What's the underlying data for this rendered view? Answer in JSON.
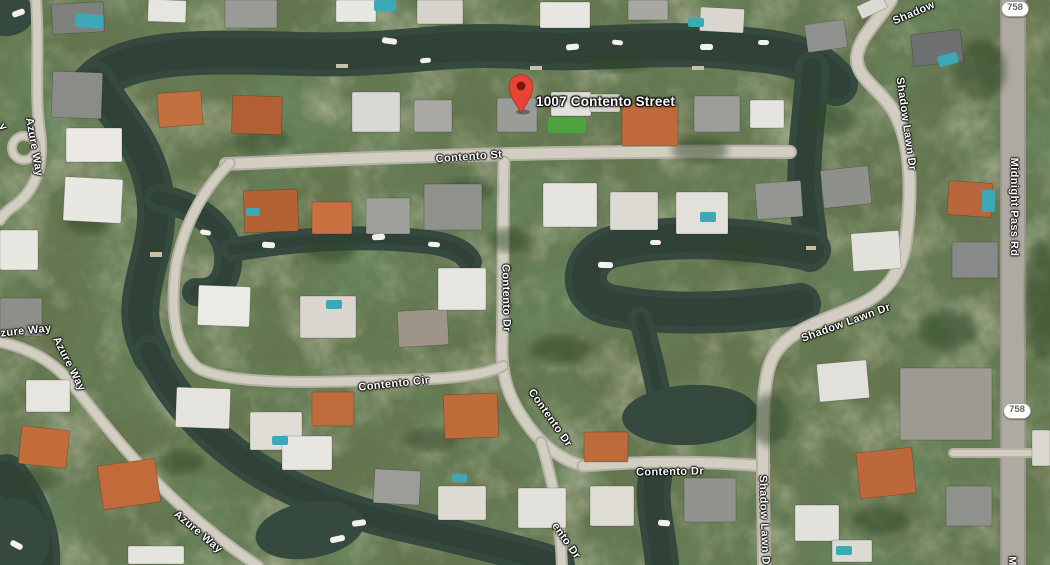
{
  "map": {
    "marker": {
      "label": "1007 Contento Street"
    },
    "street_labels": [
      {
        "name": "contento-st",
        "text": "Contento St",
        "x": 469,
        "y": 157,
        "rot": -4
      },
      {
        "name": "contento-dr-upper",
        "text": "Contento Dr",
        "x": 506,
        "y": 298,
        "rot": 89
      },
      {
        "name": "contento-cir",
        "text": "Contento Cir",
        "x": 394,
        "y": 384,
        "rot": -6
      },
      {
        "name": "contento-dr-mid",
        "text": "Contento Dr",
        "x": 550,
        "y": 418,
        "rot": 55
      },
      {
        "name": "contento-dr-lower",
        "text": "Contento Dr",
        "x": 670,
        "y": 472,
        "rot": -1
      },
      {
        "name": "contento-dr-south-partial",
        "text": "ento Dr",
        "x": 566,
        "y": 541,
        "rot": 55
      },
      {
        "name": "shadow-lawn-dr-top-partial",
        "text": "Shadow",
        "x": 914,
        "y": 13,
        "rot": -23
      },
      {
        "name": "shadow-lawn-dr-east",
        "text": "Shadow Lawn Dr",
        "x": 906,
        "y": 124,
        "rot": 82
      },
      {
        "name": "shadow-lawn-dr-mid",
        "text": "Shadow Lawn Dr",
        "x": 846,
        "y": 323,
        "rot": -20
      },
      {
        "name": "shadow-lawn-dr-south-partial",
        "text": "Shadow Lawn D",
        "x": 764,
        "y": 520,
        "rot": 88
      },
      {
        "name": "midnight-pass-rd",
        "text": "Midnight Pass Rd",
        "x": 1014,
        "y": 207,
        "rot": 90
      },
      {
        "name": "midnight-pass-rd-partial",
        "text": "M",
        "x": 1012,
        "y": 561,
        "rot": 90
      },
      {
        "name": "azure-way-north",
        "text": "Azure Way",
        "x": 34,
        "y": 147,
        "rot": 80
      },
      {
        "name": "azure-way-west-partial",
        "text": "zure Way",
        "x": 26,
        "y": 331,
        "rot": -6
      },
      {
        "name": "azure-way-mid",
        "text": "Azure Way",
        "x": 69,
        "y": 364,
        "rot": 63
      },
      {
        "name": "azure-way-south",
        "text": "Azure Way",
        "x": 198,
        "y": 532,
        "rot": 40
      },
      {
        "name": "street-partial-y",
        "text": "y",
        "x": 3,
        "y": 127,
        "rot": 55
      }
    ],
    "route_badges": [
      {
        "text": "758",
        "x": 1015,
        "y": 9
      },
      {
        "text": "758",
        "x": 1017,
        "y": 411
      }
    ]
  },
  "colors": {
    "vegetation_base": "#66754e",
    "water": "#35493e",
    "water_deep": "#2a3a31",
    "road_outer": "#b5b1a5",
    "road_inner": "#d2cec2",
    "marker_red": "#e94335",
    "marker_hole": "#791610",
    "label_text": "#ffffff",
    "badge_bg": "#fdfdfc",
    "badge_text": "#636669",
    "pool": "#3da8b6",
    "boat": "#f2f1ed",
    "dock": "#cbbfa4",
    "lawn": "#4aa53c",
    "tree": "#2f4427"
  },
  "scenery": {
    "water": [
      {
        "d": "M 92,86 C 120,52 190,50 300,54 C 400,57 440,42 520,47 C 600,52 650,40 735,48 C 780,52 815,55 836,84",
        "w": 44
      },
      {
        "d": "M 812,68 C 812,105 800,160 806,205 C 809,228 812,240 810,255",
        "w": 34
      },
      {
        "d": "M 810,250 C 745,237 665,233 612,247 C 580,256 575,296 610,305 C 672,318 745,312 800,304",
        "w": 42
      },
      {
        "d": "M 640,318 C 648,345 653,365 658,390",
        "w": 24
      },
      {
        "d": "M 95,80 C 118,118 142,140 152,180 C 163,222 150,252 143,287 C 137,317 141,333 152,356",
        "w": 38
      },
      {
        "d": "M 158,198 C 200,206 232,230 228,264 C 226,286 212,294 196,292",
        "w": 28
      },
      {
        "d": "M 232,250 C 290,240 360,234 428,242 C 452,245 466,252 470,262",
        "w": 24
      },
      {
        "d": "M 150,352 C 174,400 210,438 252,466 C 296,494 348,512 400,524 C 440,533 470,540 500,548 C 528,555 546,560 558,565",
        "w": 34
      },
      {
        "ellipse": [
          310,
          530,
          55,
          28,
          -10
        ]
      },
      {
        "ellipse": [
          690,
          415,
          68,
          30,
          -3
        ]
      },
      {
        "d": "M 655,478 C 650,505 660,535 662,565",
        "w": 34
      },
      {
        "d": "M 6,476 C 28,504 40,534 38,566",
        "w": 44
      },
      {
        "ellipse": [
          12,
          538,
          38,
          40,
          0
        ]
      },
      {
        "ellipse": [
          6,
          14,
          28,
          22,
          0
        ]
      }
    ],
    "roads": [
      {
        "d": "M 226,164 C 400,156 600,150 790,152",
        "w": 14
      },
      {
        "d": "M 504,162 C 502,230 504,300 502,345 C 501,382 512,404 530,428 C 548,451 566,462 585,466",
        "w": 13
      },
      {
        "d": "M 541,442 C 552,478 560,515 562,566",
        "w": 12
      },
      {
        "d": "M 583,466 C 645,461 706,461 764,466",
        "w": 13
      },
      {
        "d": "M 230,163 C 206,186 184,222 176,266 C 170,310 174,348 198,368 C 230,386 320,382 400,380 C 448,379 482,376 503,366",
        "w": 12
      },
      {
        "d": "M 891,0 C 876,24 860,36 857,56 C 855,78 880,88 894,112 C 910,140 913,185 906,240 C 899,291 868,302 838,314 C 800,329 777,340 769,367 C 762,392 763,430 763,470 C 763,505 764,535 764,566",
        "w": 14
      },
      {
        "d": "M 1013,0 L 1013,566",
        "w": 26,
        "c1": "#9b978f",
        "c2": "#aeaaa1"
      },
      {
        "d": "M 36,0 C 40,52 34,92 40,132 C 45,166 34,192 14,206 C 7,211 2,216 0,220",
        "w": 12
      },
      {
        "d": "M 0,342 C 28,348 52,360 72,384 C 98,416 122,448 156,482 C 190,516 222,542 258,566",
        "w": 12
      },
      {
        "d": "M 953,453 L 1050,453",
        "w": 10
      },
      {
        "circle": [
          24,
          148,
          12
        ],
        "w": 10
      }
    ],
    "buildings": [
      [
        52,
        3,
        52,
        30,
        -3,
        "#7e807c"
      ],
      [
        148,
        0,
        38,
        22,
        2,
        "#e7e5e0"
      ],
      [
        225,
        0,
        52,
        28,
        0,
        "#9a9a96"
      ],
      [
        336,
        0,
        40,
        22,
        0,
        "#e9e7e2"
      ],
      [
        417,
        0,
        46,
        24,
        0,
        "#d6d3cc"
      ],
      [
        540,
        2,
        50,
        26,
        0,
        "#e8e6e1"
      ],
      [
        628,
        0,
        40,
        20,
        0,
        "#a8a7a2"
      ],
      [
        700,
        8,
        44,
        24,
        3,
        "#d9d6cf"
      ],
      [
        806,
        22,
        40,
        28,
        -8,
        "#8f918e"
      ],
      [
        858,
        0,
        28,
        14,
        -25,
        "#dcdad4"
      ],
      [
        912,
        32,
        50,
        32,
        -6,
        "#6e7071"
      ],
      [
        52,
        72,
        50,
        46,
        2,
        "#8a8c88"
      ],
      [
        66,
        128,
        56,
        34,
        0,
        "#ece9e4"
      ],
      [
        158,
        92,
        44,
        34,
        -4,
        "#c2703f"
      ],
      [
        232,
        96,
        50,
        38,
        2,
        "#b35f33"
      ],
      [
        352,
        92,
        48,
        40,
        0,
        "#d9d8d4"
      ],
      [
        414,
        100,
        38,
        32,
        0,
        "#a9a8a3"
      ],
      [
        497,
        98,
        40,
        34,
        0,
        "#9b9c98"
      ],
      [
        551,
        92,
        40,
        24,
        0,
        "#e4e2dc"
      ],
      [
        590,
        94,
        30,
        18,
        0,
        "#d8d5ce"
      ],
      [
        622,
        104,
        56,
        42,
        0,
        "#c06a3b"
      ],
      [
        694,
        96,
        46,
        36,
        0,
        "#9d9e9a"
      ],
      [
        750,
        100,
        34,
        28,
        0,
        "#e6e4df"
      ],
      [
        64,
        178,
        58,
        44,
        3,
        "#e9e7e1"
      ],
      [
        244,
        190,
        54,
        42,
        -2,
        "#b46134"
      ],
      [
        312,
        202,
        40,
        32,
        0,
        "#c97040"
      ],
      [
        366,
        198,
        44,
        36,
        0,
        "#9fa09c"
      ],
      [
        424,
        184,
        58,
        46,
        0,
        "#8f918d"
      ],
      [
        543,
        183,
        54,
        44,
        0,
        "#e6e4de"
      ],
      [
        610,
        192,
        48,
        38,
        0,
        "#dcdad3"
      ],
      [
        676,
        192,
        52,
        42,
        0,
        "#e2e0da"
      ],
      [
        756,
        182,
        46,
        36,
        -4,
        "#959692"
      ],
      [
        198,
        286,
        52,
        40,
        2,
        "#eceae5"
      ],
      [
        300,
        296,
        56,
        42,
        0,
        "#d8d6cf"
      ],
      [
        398,
        310,
        50,
        36,
        -3,
        "#9e9488"
      ],
      [
        438,
        268,
        48,
        42,
        0,
        "#e8e6e0"
      ],
      [
        822,
        168,
        48,
        38,
        -6,
        "#8e908c"
      ],
      [
        852,
        232,
        48,
        38,
        -4,
        "#e3e1db"
      ],
      [
        948,
        182,
        44,
        34,
        4,
        "#b9663a"
      ],
      [
        952,
        242,
        46,
        36,
        0,
        "#87898a"
      ],
      [
        0,
        230,
        38,
        40,
        0,
        "#e9e7e1"
      ],
      [
        0,
        298,
        42,
        38,
        0,
        "#8d8f8b"
      ],
      [
        26,
        380,
        44,
        32,
        0,
        "#e7e5df"
      ],
      [
        20,
        428,
        48,
        38,
        6,
        "#c26c3c"
      ],
      [
        100,
        462,
        58,
        44,
        -8,
        "#c16a3a"
      ],
      [
        128,
        546,
        56,
        18,
        0,
        "#e6e4de"
      ],
      [
        176,
        388,
        54,
        40,
        2,
        "#e5e3dd"
      ],
      [
        250,
        412,
        52,
        38,
        0,
        "#dfddd6"
      ],
      [
        312,
        392,
        42,
        34,
        0,
        "#c06b3b"
      ],
      [
        444,
        394,
        54,
        44,
        -2,
        "#bf6b39"
      ],
      [
        584,
        432,
        44,
        30,
        0,
        "#bf6a3a"
      ],
      [
        282,
        436,
        50,
        34,
        0,
        "#e8e6e0"
      ],
      [
        374,
        470,
        46,
        34,
        3,
        "#9c9d99"
      ],
      [
        438,
        486,
        48,
        34,
        0,
        "#dddbd4"
      ],
      [
        518,
        488,
        48,
        40,
        0,
        "#e3e1db"
      ],
      [
        590,
        486,
        44,
        40,
        0,
        "#dedcd5"
      ],
      [
        684,
        478,
        52,
        44,
        0,
        "#90928e"
      ],
      [
        818,
        362,
        50,
        38,
        -5,
        "#e2e0da"
      ],
      [
        900,
        368,
        92,
        72,
        0,
        "#9d9a91"
      ],
      [
        858,
        450,
        56,
        46,
        -6,
        "#bd683a"
      ],
      [
        946,
        486,
        46,
        40,
        0,
        "#8f918d"
      ],
      [
        795,
        505,
        44,
        36,
        0,
        "#e4e2dc"
      ],
      [
        832,
        540,
        40,
        22,
        0,
        "#dcdad3"
      ],
      [
        1032,
        430,
        18,
        36,
        0,
        "#dad7d0"
      ]
    ],
    "pools": [
      [
        938,
        54,
        20,
        11,
        -15
      ],
      [
        982,
        190,
        13,
        22,
        0
      ],
      [
        75,
        14,
        28,
        14,
        5
      ],
      [
        246,
        208,
        14,
        8,
        0
      ],
      [
        326,
        300,
        16,
        9,
        0
      ],
      [
        700,
        212,
        16,
        10,
        0
      ],
      [
        272,
        436,
        16,
        9,
        0
      ],
      [
        452,
        474,
        15,
        8,
        0
      ],
      [
        836,
        546,
        16,
        9,
        0
      ],
      [
        374,
        0,
        22,
        11,
        0
      ],
      [
        688,
        18,
        16,
        9,
        0
      ]
    ],
    "boats": [
      [
        382,
        38,
        15,
        6,
        8
      ],
      [
        420,
        58,
        11,
        5,
        -4
      ],
      [
        566,
        44,
        13,
        6,
        -6
      ],
      [
        612,
        40,
        11,
        5,
        6
      ],
      [
        700,
        44,
        13,
        6,
        0
      ],
      [
        758,
        40,
        11,
        5,
        0
      ],
      [
        598,
        262,
        15,
        6,
        2
      ],
      [
        650,
        240,
        11,
        5,
        0
      ],
      [
        330,
        536,
        15,
        6,
        -12
      ],
      [
        352,
        520,
        14,
        6,
        -8
      ],
      [
        10,
        542,
        13,
        6,
        28
      ],
      [
        12,
        10,
        13,
        6,
        -20
      ],
      [
        262,
        242,
        13,
        6,
        3
      ],
      [
        372,
        234,
        13,
        6,
        -3
      ],
      [
        428,
        242,
        12,
        5,
        4
      ],
      [
        658,
        520,
        12,
        6,
        4
      ],
      [
        200,
        230,
        11,
        5,
        10
      ]
    ],
    "docks": [
      [
        336,
        64,
        12,
        4
      ],
      [
        530,
        66,
        12,
        4
      ],
      [
        692,
        66,
        12,
        4
      ],
      [
        150,
        252,
        12,
        5
      ],
      [
        806,
        246,
        10,
        4
      ]
    ],
    "lawns": [
      [
        548,
        117,
        38,
        16
      ]
    ],
    "trees": [
      [
        260,
        140,
        30,
        14
      ],
      [
        470,
        190,
        26,
        12
      ],
      [
        700,
        150,
        28,
        13
      ],
      [
        560,
        350,
        30,
        14
      ],
      [
        430,
        440,
        28,
        12
      ],
      [
        830,
        120,
        26,
        16
      ],
      [
        948,
        330,
        30,
        20
      ],
      [
        1042,
        300,
        16,
        60
      ],
      [
        90,
        220,
        24,
        14
      ],
      [
        330,
        250,
        26,
        12
      ],
      [
        620,
        62,
        30,
        10
      ],
      [
        180,
        462,
        24,
        12
      ],
      [
        740,
        252,
        24,
        12
      ],
      [
        880,
        520,
        28,
        14
      ],
      [
        40,
        480,
        22,
        12
      ],
      [
        510,
        240,
        22,
        12
      ],
      [
        770,
        420,
        20,
        26
      ],
      [
        980,
        70,
        26,
        30
      ]
    ]
  }
}
